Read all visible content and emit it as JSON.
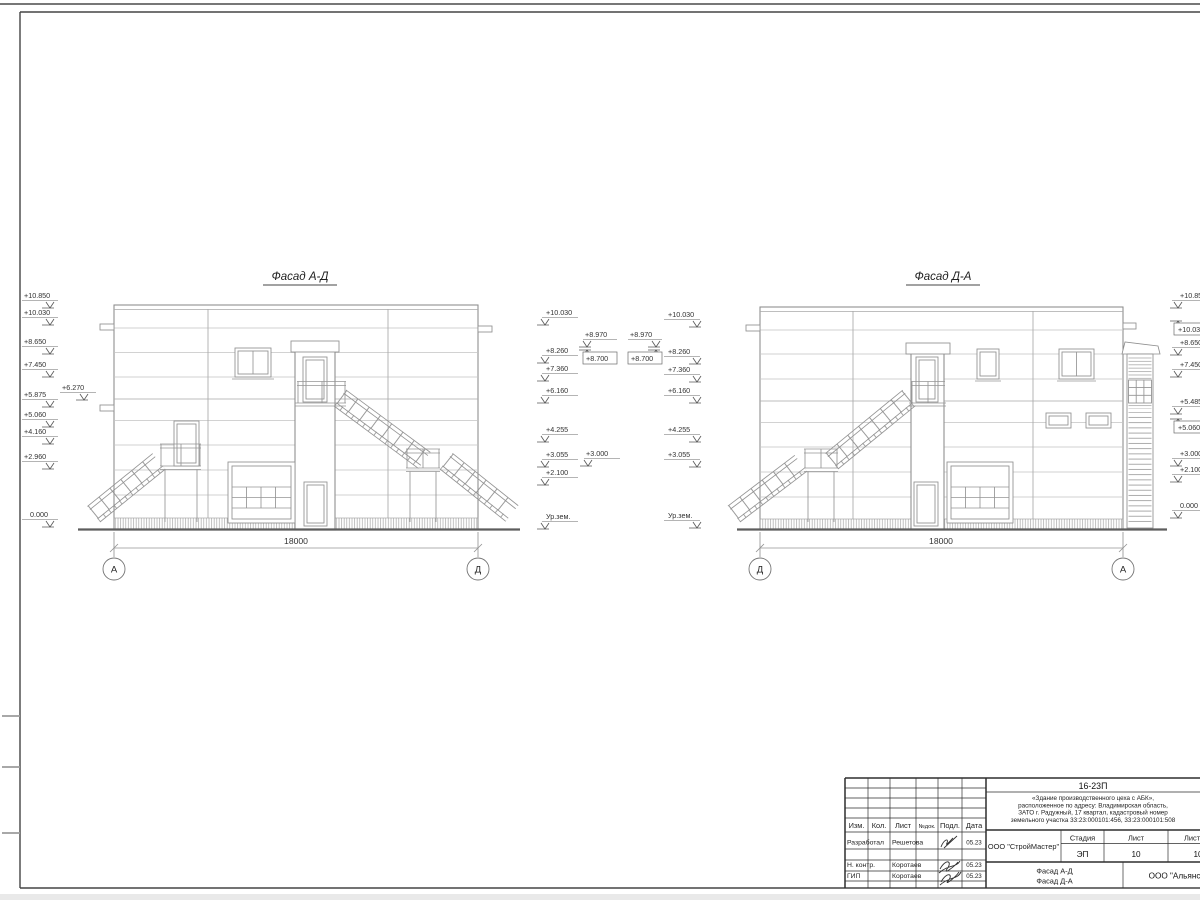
{
  "facade_left": {
    "title": "Фасад А-Д",
    "marks_left": [
      "+10.850",
      "+10.030",
      "+8.650",
      "+7.450",
      "+5.875",
      "+5.060",
      "+4.160",
      "+2.960",
      "0.000"
    ],
    "mark_platform": "+6.270",
    "marks_right": [
      "+10.030",
      "+8.260",
      "+7.360",
      "+6.160",
      "+4.255",
      "+3.055",
      "+2.100",
      "Ур.зем."
    ],
    "canopy_marks": [
      "+8.970",
      "+8.700"
    ],
    "mark_landing": "+3.000",
    "dimension": "18000",
    "axis_left": "А",
    "axis_right": "Д"
  },
  "facade_right": {
    "title": "Фасад Д-А",
    "canopy_marks": [
      "+8.970",
      "+8.700"
    ],
    "marks_left": [
      "+10.030",
      "+8.260",
      "+7.360",
      "+6.160",
      "+4.255",
      "+3.055",
      "Ур.зем."
    ],
    "marks_right": [
      "+10.850",
      "+10.030",
      "+8.650",
      "+7.450",
      "+5.485",
      "+5.060",
      "+3.000",
      "+2.100",
      "0.000"
    ],
    "dimension": "18000",
    "axis_left": "Д",
    "axis_right": "А"
  },
  "title_block": {
    "doc_number": "16-23П",
    "project_lines": [
      "«Здание производственного цеха с АБК»,",
      "расположенное по адресу: Владимирская область,",
      "ЗАТО г. Радужный, 17 квартал, кадастровый номер",
      "земельного участка 33:23:000101:456, 33:23:000101:508"
    ],
    "col_headers": [
      "Изм.",
      "Кол.",
      "Лист",
      "№док.",
      "Подл.",
      "Дата"
    ],
    "rows": [
      {
        "role": "Разработал",
        "name": "Решетова",
        "date": "05.23"
      },
      {
        "role": "Н. контр.",
        "name": "Коротаев",
        "date": "05.23"
      },
      {
        "role": "ГИП",
        "name": "Коротаев",
        "date": "05.23"
      }
    ],
    "contractor": "ООО \"СтройМастер\"",
    "stage_header": "Стадия",
    "sheet_header": "Лист",
    "sheets_header": "Листов",
    "stage": "ЭП",
    "sheet_no": "10",
    "sheets_total": "10",
    "sheet_name_line1": "Фасад А-Д",
    "sheet_name_line2": "Фасад Д-А",
    "client": "ООО \"Альянс\""
  }
}
